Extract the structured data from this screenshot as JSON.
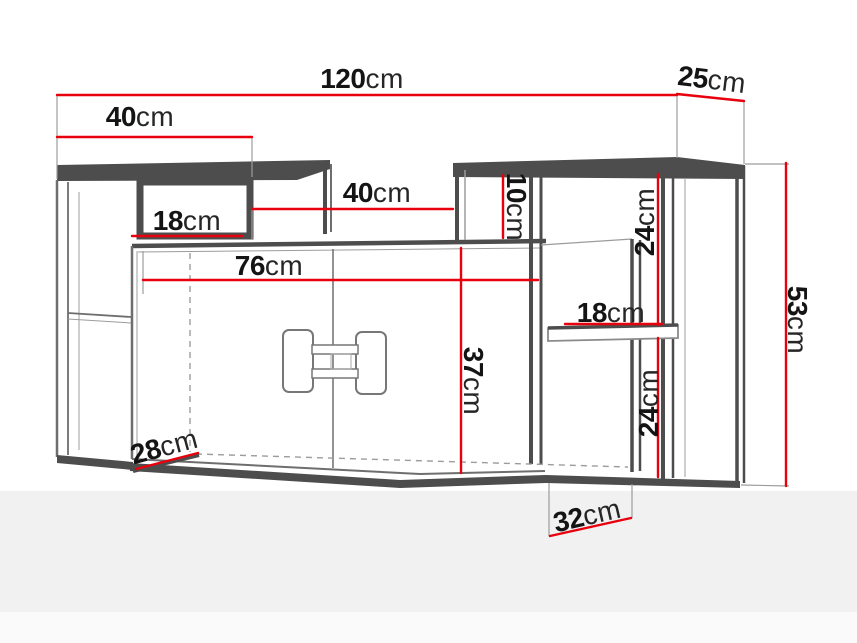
{
  "figure": {
    "kind": "furniture-dimension-diagram",
    "unit": "cm"
  },
  "dimensions": {
    "total_width": {
      "value": "120",
      "unit": "cm"
    },
    "top_depth": {
      "value": "25",
      "unit": "cm"
    },
    "left_shelf_width": {
      "value": "40",
      "unit": "cm"
    },
    "middle_niche_width": {
      "value": "40",
      "unit": "cm"
    },
    "left_niche_width": {
      "value": "18",
      "unit": "cm"
    },
    "door_section_width": {
      "value": "76",
      "unit": "cm"
    },
    "right_top_niche_height": {
      "value": "10",
      "unit": "cm"
    },
    "right_upper_niche_height": {
      "value": "24",
      "unit": "cm"
    },
    "right_shelf_width": {
      "value": "18",
      "unit": "cm"
    },
    "door_height": {
      "value": "37",
      "unit": "cm"
    },
    "total_height": {
      "value": "53",
      "unit": "cm"
    },
    "right_lower_niche_height": {
      "value": "24",
      "unit": "cm"
    },
    "bottom_left_depth": {
      "value": "28",
      "unit": "cm"
    },
    "bottom_depth": {
      "value": "32",
      "unit": "cm"
    }
  },
  "colors": {
    "dimension_red": "#e8000d",
    "frame_dark": "#4d4d4d",
    "line_mid": "#6e6e6e",
    "line_light": "#9c9c9c",
    "label_black": "#141414",
    "floor_gray": "#f1f1f1"
  }
}
